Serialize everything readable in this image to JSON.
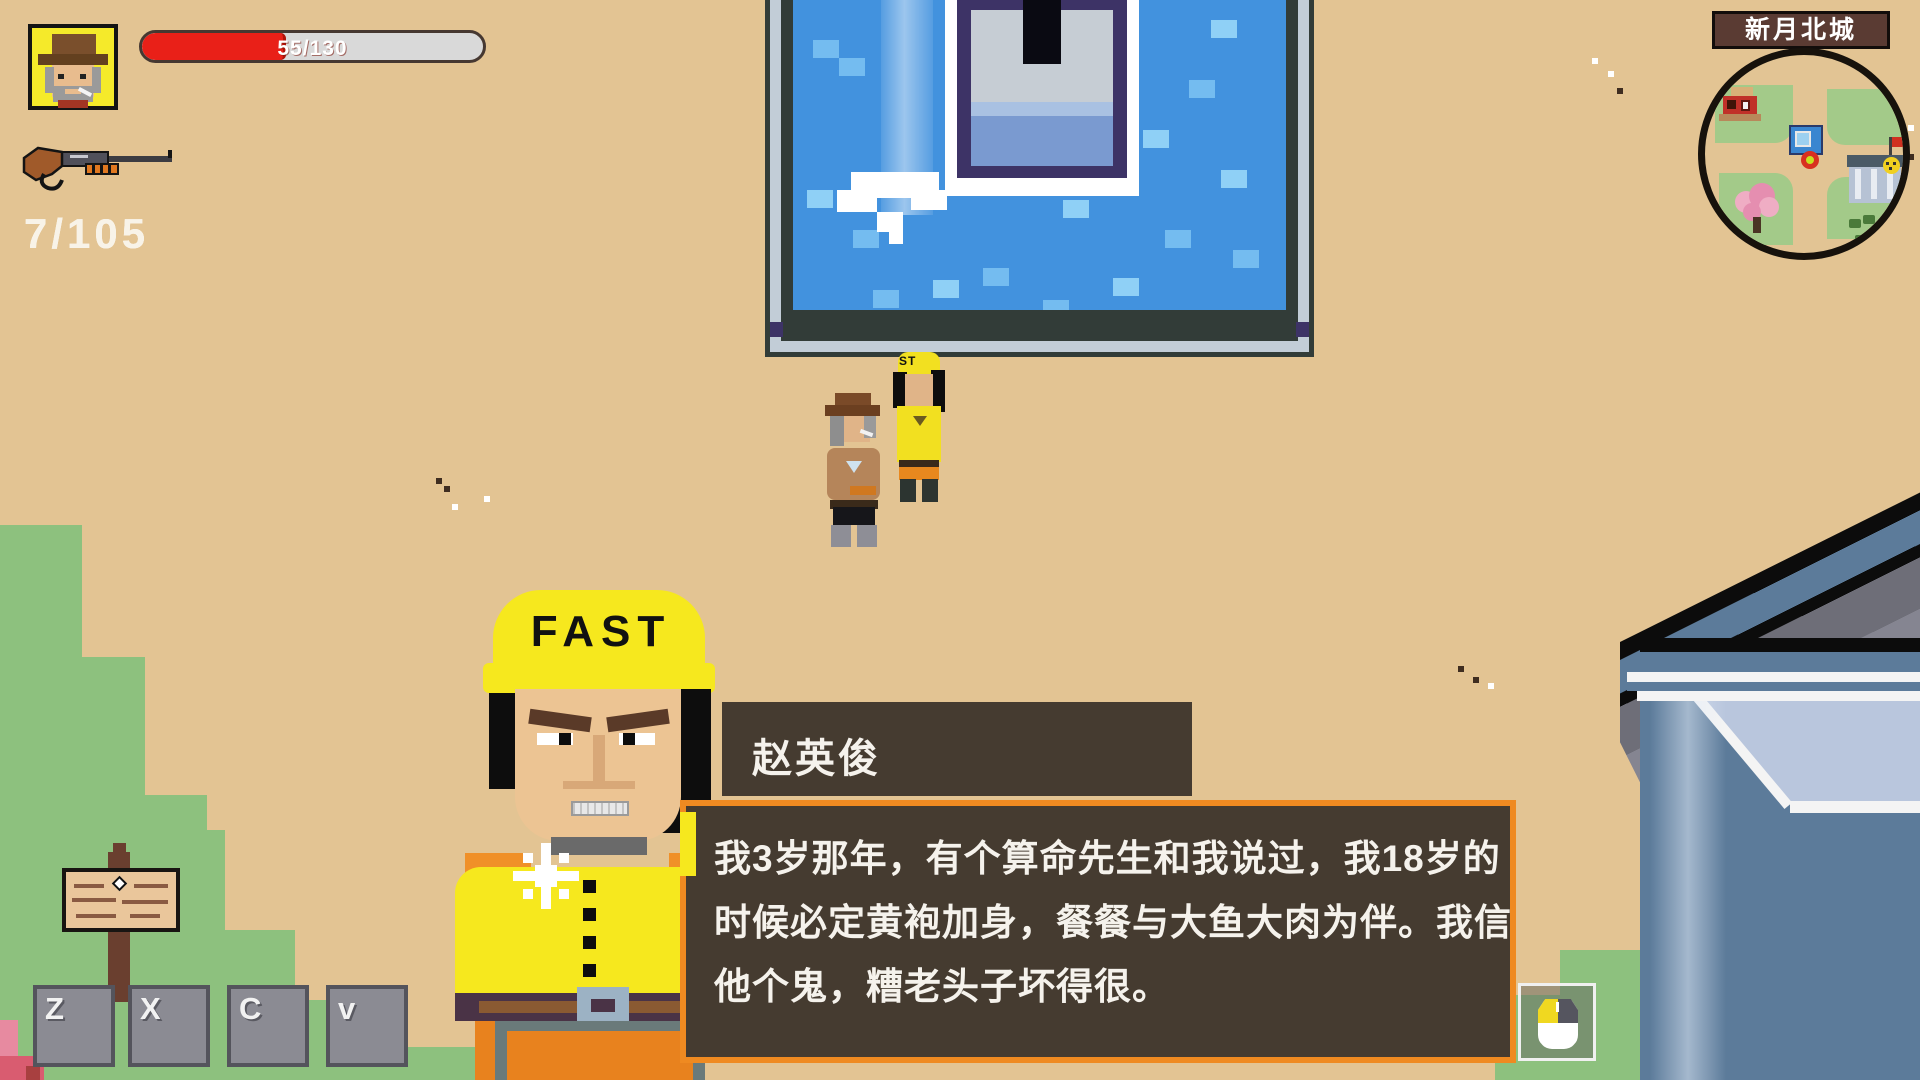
{
  "hud": {
    "health": {
      "current": 55,
      "max": 130,
      "label": "55/130",
      "percent": 42.3,
      "fill_color": "#e92018",
      "track_color": "#d9d9d9"
    },
    "ammo": {
      "label": "7/105",
      "loaded": 7,
      "reserve": 105
    },
    "weapon_icon": "shotgun-icon",
    "keys": [
      {
        "label": "Z"
      },
      {
        "label": "X"
      },
      {
        "label": "C"
      },
      {
        "label": "v"
      }
    ],
    "mouse_hint_icon": "mouse-icon"
  },
  "minimap": {
    "title": "新月北城",
    "icons": [
      "house-icon",
      "pool-icon",
      "player-marker",
      "building-icon",
      "flag-icon",
      "smiley-icon",
      "tree-icon",
      "bush-icon"
    ]
  },
  "dialog": {
    "speaker": "赵英俊",
    "lines": [
      "我3岁那年，有个算命先生和我说过，我18岁的",
      "时候必定黄袍加身，餐餐与大鱼大肉为伴。我信",
      "他个鬼，糟老头子坏得很。"
    ],
    "full_text": "我3岁那年，有个算命先生和我说过，我18岁的时候必定黄袍加身，餐餐与大鱼大肉为伴。我信他个鬼，糟老头子坏得很。",
    "portrait_helmet_text": "FAST",
    "box_color": "#453b30",
    "border_color": "#ef8a21"
  },
  "world": {
    "npc_cap_text": "ST",
    "ground_color": "#e3c493",
    "grass_color": "#8dc17e",
    "water_color": "#4292de"
  }
}
